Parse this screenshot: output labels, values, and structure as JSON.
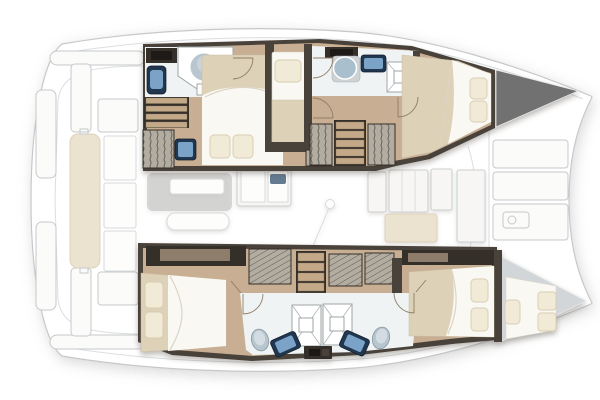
{
  "meta": {
    "title": "Catamaran yacht interior layout — overhead deck plan, bow to the right",
    "type": "floor-plan"
  },
  "colors": {
    "wall": "#49423a",
    "wall-dark": "#352f29",
    "floor": "#c8ae92",
    "bath": "#f0f3f3",
    "bed-base": "#ddd1b8",
    "mattress": "#f9f8f3",
    "pillow": "#f1ead7",
    "pillow-edge": "#d8cdb0",
    "sink-navy": "#213750",
    "basin-blue": "#7ba3c8",
    "toilet": "#b7c5cf",
    "toilet-edge": "#8798a3",
    "step": "#c3a987",
    "locker-gray": "#717171",
    "forepeak-gray": "#d2d6d8",
    "outline": "#c6c9cb",
    "door": "#8f7e66",
    "beige": "#ebe3d0",
    "salon-gray": "#bdbdbb"
  },
  "plan": {
    "orientation": "bow right, stern left",
    "areas": [
      {
        "name": "aft-cockpit",
        "features": [
          "bench-cushion",
          "folding-table-leaves",
          "cockpit-seats",
          "roof-supports"
        ]
      },
      {
        "name": "salon",
        "features": [
          "settee-with-table",
          "sofa-bench",
          "galley-unit-with-sink",
          "mast-step",
          "galley-counters",
          "nav-seat-mat"
        ]
      },
      {
        "name": "port-hull",
        "features": [
          "aft-shower-room",
          "round-shower",
          "washbasin",
          "companionway-steps",
          "hanging-locker",
          "vanity-sink",
          "aft-double-berth-2-pillows",
          "single-berth-1-pillow",
          "forward-shower-room",
          "pedestal-basin",
          "washbasin",
          "shower-tray",
          "forward-steps",
          "hanging-lockers",
          "forward-double-berth-2-pillows",
          "bow-locker"
        ]
      },
      {
        "name": "starboard-hull",
        "features": [
          "aft-double-berth-2-pillows",
          "hanging-lockers",
          "companionway-steps",
          "twin-shower-rooms",
          "two-shower-trays",
          "two-wc-toilets",
          "two-washbasins",
          "center-cabinet",
          "forward-double-berth-2-pillows",
          "forepeak-berth-with-pillows"
        ]
      },
      {
        "name": "foredeck",
        "features": [
          "deck-hatches",
          "windlass"
        ]
      }
    ]
  }
}
